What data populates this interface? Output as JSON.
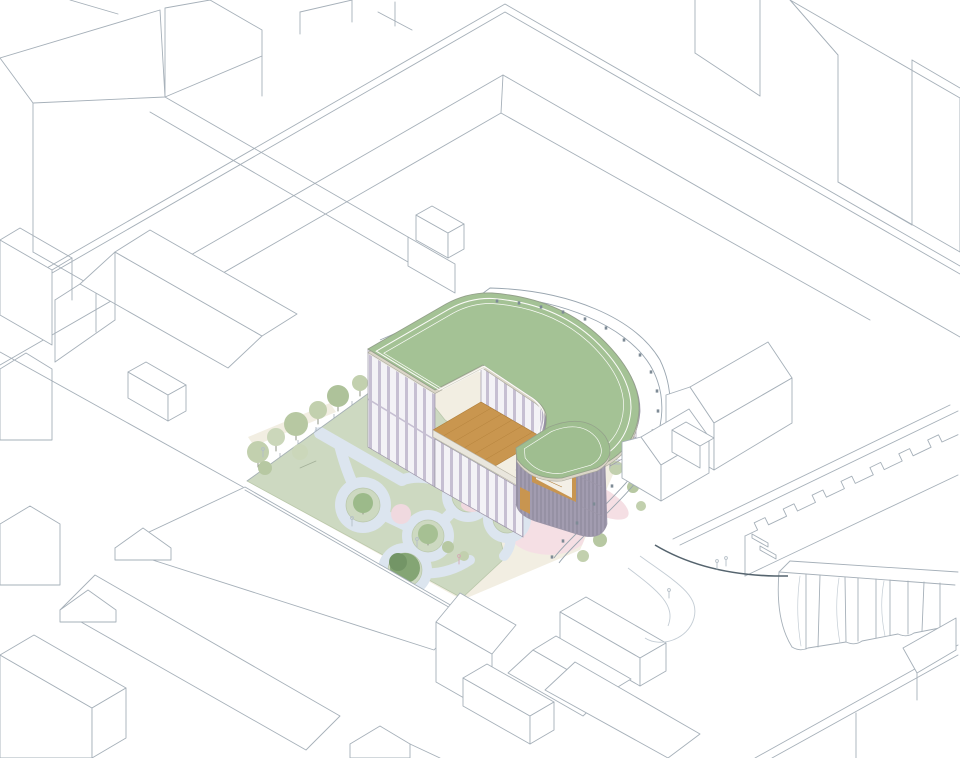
{
  "scene": {
    "type": "architectural-axonometric-site-plan",
    "description": "White line-drawn city blocks surrounding a nursery building with rounded green roof, rooftop wood terrace, glazed lavender facades, lawn courtyard with looping play path, tree islands and a curved bollard-lined promenade",
    "text_content": "none",
    "counts": {
      "perimeter_bollards": 19,
      "tree_islands": 5,
      "fence_trees": 9,
      "sawtooth_teeth": 7
    }
  },
  "palette": {
    "background": "#ffffff",
    "context_line": "#a6b0b9",
    "soft_line": "#c3ccd4",
    "lawn": "#cdd9c1",
    "lawn_edge": "#b9c7aa",
    "green_strip": "#dfe8d5",
    "play_path": "#dce5ef",
    "cream_paving": "#f2eee2",
    "pink_paving": "#f5dfe4",
    "pink_circle": "#f0d9df",
    "roof_green": "#a4c295",
    "roof_green_low": "#9fbe90",
    "parapet": "#dbd6c8",
    "facade_glazing": "#f3f2f6",
    "facade_mullion": "#c6bfd2",
    "facade_slats": "#a29cb0",
    "slat_line": "#8f8a9d",
    "terrace_wood": "#c9964f",
    "window_wood": "#c89550",
    "window_glass": "#f3efe6",
    "tree_light": "#c2d0ae",
    "tree_mid": "#a6c093",
    "tree_dark": "#84a574",
    "tree_pink": "#d9bfc7",
    "bollard": "#7e8b96",
    "road_dark": "#55646e",
    "figure_line": "#b4bec7"
  }
}
